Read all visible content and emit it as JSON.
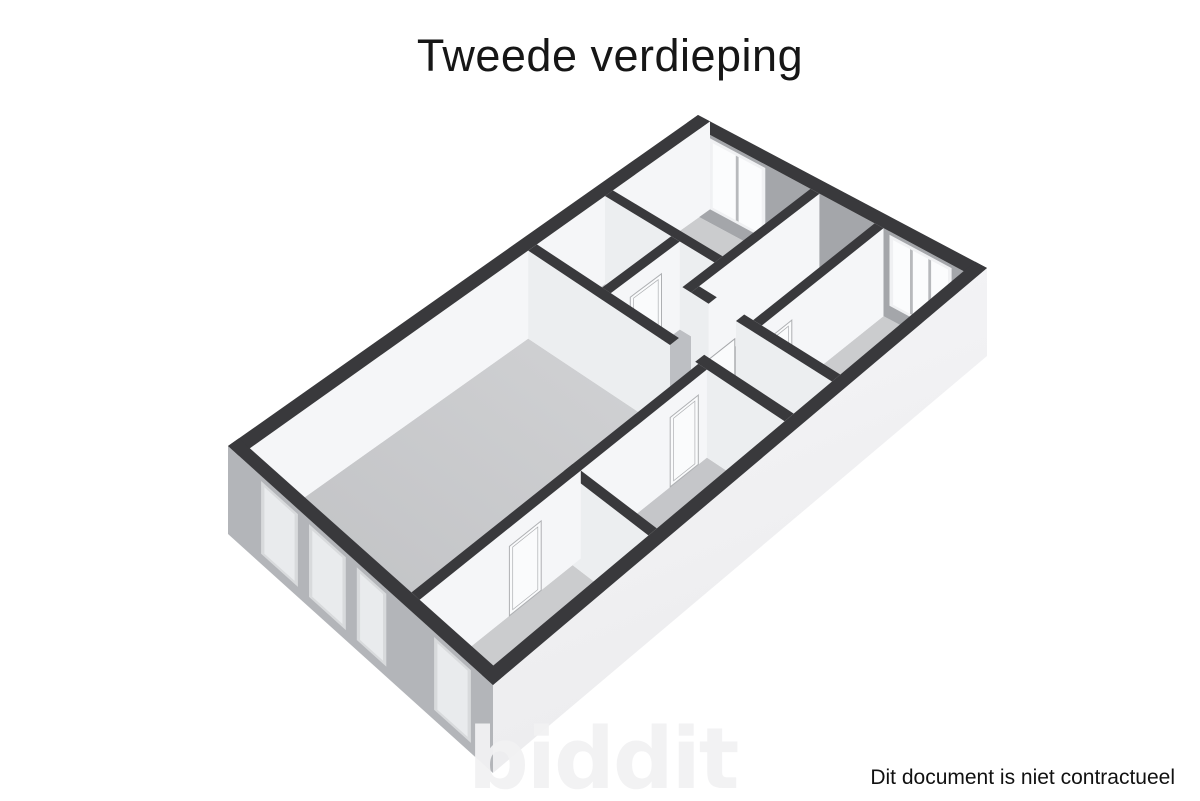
{
  "title": "Tweede verdieping",
  "watermark": "biddit",
  "footer": {
    "disclaimer": "Dit document is niet contractueel"
  },
  "floorplan": {
    "description": "3d-isometric-floorplan-second-floor",
    "projection": {
      "plan_width_m": 7.2,
      "plan_length_m": 13,
      "wall_height_m": 2.6,
      "px_per_m_vertical": 33.85,
      "top_corners": {
        "north": [
          698,
          115
        ],
        "east": [
          987,
          268
        ],
        "west": [
          228,
          446
        ],
        "south": [
          493,
          685
        ]
      }
    },
    "colors": {
      "wall_top": "#39393c",
      "face_u_bright": "#f5f6f8",
      "face_v_light": "#eceef0",
      "ne_inner_gray": "#a4a6aa",
      "se_outer_top": "#f6f6f8",
      "se_outer_bottom": "#ececee",
      "sw_outer_gray": "#b3b5b9",
      "floor_light": "#cbccce",
      "floor_mid": "#c5c6c9",
      "floor_hall": "#bdbfc3",
      "floor_br_light": "#d2d3d5",
      "floor_br_dark": "#bebfc2",
      "window_frame": "#f0f1f3",
      "window_glass": "#fbfcfd",
      "window_mullion": "#b7b9bc",
      "sw_window_frame": "#d8dadc",
      "sw_window_glass": "#e9ebed",
      "door_fill": "#fafbfc",
      "door_stroke": "#aeb0b3",
      "toilet_fill": "#f1f2f3",
      "toilet_stroke": "#b8babd"
    },
    "rooms": [
      {
        "id": "room-top",
        "u1": 0.3,
        "v1": 0.3,
        "u2": 3.08,
        "v2": 2.68,
        "fill": "floor_light"
      },
      {
        "id": "wc",
        "u1": 0.3,
        "v1": 2.9,
        "u2": 1.98,
        "v2": 4.78,
        "fill": "floor_mid"
      },
      {
        "id": "hall-a",
        "u1": 2.2,
        "v1": 2.9,
        "u2": 3.3,
        "v2": 4.78,
        "fill": "floor_hall"
      },
      {
        "id": "hall-b",
        "u1": 3.3,
        "v1": 3.77,
        "u2": 6.9,
        "v2": 4.78,
        "fill": "floor_hall"
      },
      {
        "id": "doorway-mid",
        "u1": 3.75,
        "v1": 3.55,
        "u2": 4.45,
        "v2": 3.77,
        "fill": "floor_hall"
      },
      {
        "id": "doorway-main",
        "u1": 3.95,
        "v1": 4.78,
        "u2": 4.6,
        "v2": 5.02,
        "fill": "floor_hall"
      },
      {
        "id": "room-middle",
        "u1": 3.3,
        "v1": 0.3,
        "u2": 4.68,
        "v2": 3.55,
        "fill": "floor_mid"
      },
      {
        "id": "room-right",
        "u1": 4.9,
        "v1": 0.3,
        "u2": 6.9,
        "v2": 3.55,
        "fill": "floor_light"
      },
      {
        "id": "room-living",
        "u1": 0.3,
        "v1": 5.02,
        "u2": 4.68,
        "v2": 12.7,
        "fill": "GRADIENT_BR"
      },
      {
        "id": "room-small",
        "u1": 4.9,
        "v1": 5.02,
        "u2": 6.9,
        "v2": 8.39,
        "fill": "floor_mid"
      },
      {
        "id": "room-bottom",
        "u1": 4.9,
        "v1": 8.61,
        "u2": 6.9,
        "v2": 12.7,
        "fill": "floor_light"
      }
    ],
    "walls": [
      {
        "id": "outer-ne",
        "u1": 0,
        "v1": 0,
        "u2": 7.2,
        "v2": 0.3,
        "face": "v",
        "fill": "ne_inner_gray"
      },
      {
        "id": "outer-nw",
        "u1": 0,
        "v1": 0,
        "u2": 0.3,
        "v2": 13,
        "face": "u",
        "fill": "face_u_bright"
      },
      {
        "id": "divider-top",
        "u1": 0.3,
        "v1": 2.68,
        "u2": 3.08,
        "v2": 2.9,
        "face": "v",
        "fill": "face_v_light"
      },
      {
        "id": "wall-topright",
        "u1": 3.08,
        "v1": 0.3,
        "u2": 3.3,
        "v2": 3.77,
        "face": "u",
        "fill": "face_u_bright"
      },
      {
        "id": "wall-wc-right",
        "u1": 1.98,
        "v1": 2.9,
        "u2": 2.2,
        "v2": 4.78,
        "face": "u",
        "fill": "face_u_bright"
      },
      {
        "id": "wall-right-left",
        "u1": 4.68,
        "v1": 0.3,
        "u2": 4.9,
        "v2": 3.55,
        "face": "u",
        "fill": "face_u_bright"
      },
      {
        "id": "wall-mid-a",
        "u1": 3.3,
        "v1": 3.55,
        "u2": 3.75,
        "v2": 3.77,
        "face": "v",
        "fill": "face_v_light"
      },
      {
        "id": "wall-mid-b",
        "u1": 4.45,
        "v1": 3.55,
        "u2": 6.9,
        "v2": 3.77,
        "face": "v",
        "fill": "face_v_light"
      },
      {
        "id": "divider-main-a",
        "u1": 0.3,
        "v1": 4.78,
        "u2": 3.95,
        "v2": 5.02,
        "face": "v",
        "fill": "face_v_light"
      },
      {
        "id": "divider-main-b",
        "u1": 4.6,
        "v1": 4.78,
        "u2": 6.9,
        "v2": 5.02,
        "face": "v",
        "fill": "face_v_light"
      },
      {
        "id": "wall-small-left",
        "u1": 4.68,
        "v1": 5.02,
        "u2": 4.9,
        "v2": 8.61,
        "face": "u",
        "fill": "face_u_bright"
      },
      {
        "id": "wall-small-bottom",
        "u1": 4.9,
        "v1": 8.39,
        "u2": 6.9,
        "v2": 8.61,
        "face": "v",
        "fill": "face_v_light"
      },
      {
        "id": "wall-bottom-left",
        "u1": 4.68,
        "v1": 8.39,
        "u2": 4.9,
        "v2": 12.7,
        "face": "u",
        "fill": "face_u_bright"
      },
      {
        "id": "outer-sw",
        "u1": 0,
        "v1": 12.7,
        "u2": 7.2,
        "v2": 13,
        "face": "v",
        "fill": "sw_outer_gray"
      },
      {
        "id": "outer-se",
        "u1": 6.9,
        "v1": 0,
        "u2": 7.2,
        "v2": 13,
        "face": "u",
        "fill": "GRADIENT_SE"
      }
    ],
    "windows": [
      {
        "id": "window-top-room",
        "wall": "outer-ne",
        "u1": 0.55,
        "u2": 1.95,
        "z1": 0.4,
        "z2": 2.5,
        "panes": 2,
        "style": "inner"
      },
      {
        "id": "window-right-room",
        "wall": "outer-ne",
        "u1": 5.05,
        "u2": 6.6,
        "z1": 0.4,
        "z2": 2.5,
        "panes": 3,
        "style": "inner"
      },
      {
        "id": "window-sw-1",
        "wall": "outer-sw",
        "u1": 0.9,
        "u2": 1.9,
        "z1": 0.3,
        "z2": 2.45,
        "panes": 1,
        "style": "outer"
      },
      {
        "id": "window-sw-2",
        "wall": "outer-sw",
        "u1": 2.2,
        "u2": 3.2,
        "z1": 0.3,
        "z2": 2.45,
        "panes": 1,
        "style": "outer"
      },
      {
        "id": "window-sw-3",
        "wall": "outer-sw",
        "u1": 3.5,
        "u2": 4.3,
        "z1": 0.3,
        "z2": 2.45,
        "panes": 1,
        "style": "outer"
      },
      {
        "id": "window-sw-4",
        "wall": "outer-sw",
        "u1": 5.6,
        "u2": 6.6,
        "z1": 0.3,
        "z2": 2.45,
        "panes": 1,
        "style": "outer"
      }
    ],
    "doors": [
      {
        "id": "door-wc",
        "wall": "wall-wc-right",
        "v1": 3.4,
        "v2": 4.25,
        "h": 2.05
      },
      {
        "id": "door-right-room",
        "wall": "wall-right-left",
        "v1": 2.75,
        "v2": 3.45,
        "h": 2.05
      },
      {
        "id": "door-small-room",
        "wall": "wall-small-left",
        "v1": 5.25,
        "v2": 6.0,
        "h": 2.05
      },
      {
        "id": "door-bottom-room",
        "wall": "wall-bottom-left",
        "v1": 9.45,
        "v2": 10.3,
        "h": 2.05
      }
    ],
    "door_leaves": [
      {
        "id": "leaf-middle-room",
        "u": 4.42,
        "v1": 3.77,
        "v2": 4.5,
        "h": 2.05
      },
      {
        "id": "leaf-living-room",
        "u": 4.56,
        "v1": 5.02,
        "v2": 5.82,
        "h": 2.05
      }
    ],
    "toilet": {
      "id": "toilet",
      "cu": 1.5,
      "cv": 4.4,
      "tank_u1": 1.62,
      "tank_v1": 4.08,
      "tank_u2": 1.94,
      "tank_v2": 4.7
    }
  }
}
